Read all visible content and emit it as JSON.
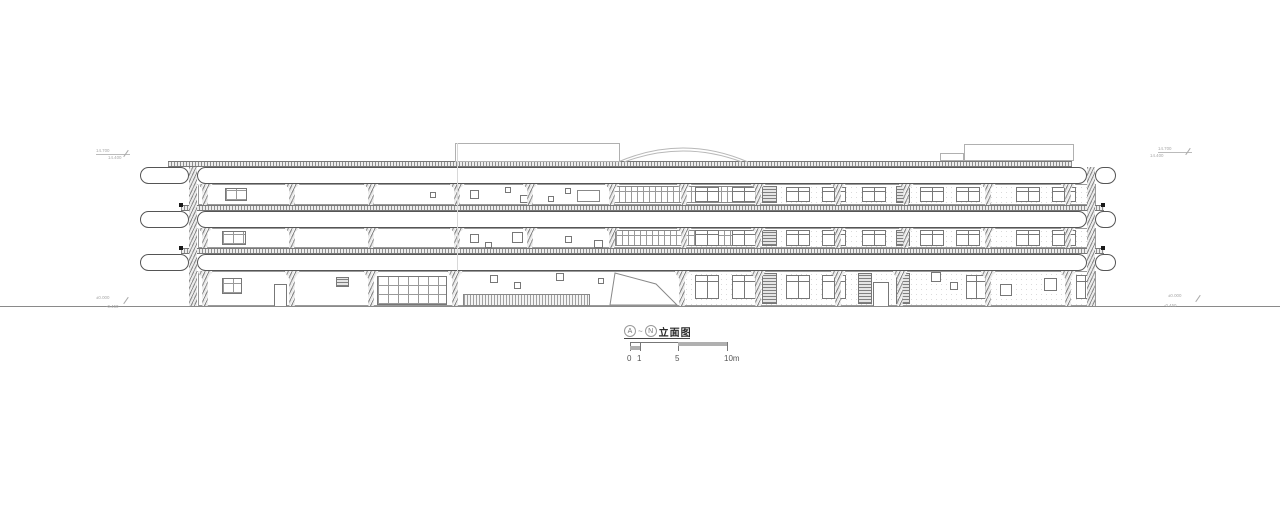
{
  "title_block": {
    "mark_a": "A",
    "tilde": "~",
    "mark_n": "N",
    "title": "立面图"
  },
  "scale_bar": {
    "y": 342,
    "x0": 630,
    "x1": 727,
    "ticks": [
      {
        "x": 630,
        "label": "0"
      },
      {
        "x": 640,
        "label": "1"
      },
      {
        "x": 678,
        "label": "5"
      },
      {
        "x": 727,
        "label": "10m"
      }
    ],
    "fills": [
      {
        "x": 678,
        "dy": 0,
        "w": 49,
        "h": 4
      },
      {
        "x": 630,
        "dy": 4,
        "w": 10,
        "h": 4
      }
    ]
  },
  "drawing": {
    "colors": {
      "ink": "#555555",
      "light": "#aaaaaa",
      "hatch": "#8a8a8a",
      "paper": "#ffffff"
    },
    "ground_y": 306,
    "joint_line": {
      "x": 457,
      "y": 143,
      "h": 129
    },
    "levels": [
      {
        "strip": {
          "x": 168,
          "y": 161,
          "w": 904,
          "h": 6
        },
        "capsules": [
          {
            "x": 140,
            "y": 167,
            "w": 49,
            "h": 17
          },
          {
            "x": 197,
            "y": 167,
            "w": 890,
            "h": 17
          },
          {
            "x": 1095,
            "y": 167,
            "w": 21,
            "h": 17
          }
        ]
      },
      {
        "strip": {
          "x": 181,
          "y": 205,
          "w": 923,
          "h": 6
        },
        "capsules": [
          {
            "x": 140,
            "y": 211,
            "w": 49,
            "h": 17
          },
          {
            "x": 197,
            "y": 211,
            "w": 890,
            "h": 17
          },
          {
            "x": 1095,
            "y": 211,
            "w": 21,
            "h": 17
          }
        ]
      },
      {
        "strip": {
          "x": 181,
          "y": 248,
          "w": 923,
          "h": 6
        },
        "capsules": [
          {
            "x": 140,
            "y": 254,
            "w": 49,
            "h": 17
          },
          {
            "x": 197,
            "y": 254,
            "w": 890,
            "h": 17
          },
          {
            "x": 1095,
            "y": 254,
            "w": 21,
            "h": 17
          }
        ]
      }
    ],
    "edge_columns": [
      {
        "x": 189,
        "y": 167,
        "w": 8,
        "h": 139
      },
      {
        "x": 1087,
        "y": 167,
        "w": 8,
        "h": 139
      }
    ],
    "dots": [
      [
        179,
        203
      ],
      [
        179,
        246
      ],
      [
        1101,
        203
      ],
      [
        1101,
        246
      ]
    ],
    "col_w": 16,
    "floors": [
      {
        "name": "third-floor",
        "y": 184,
        "h": 21,
        "wall_x": 198,
        "wall_w": 898,
        "columns": [
          205,
          292,
          371,
          457,
          530,
          612,
          684,
          758,
          838,
          906,
          988,
          1068
        ],
        "elements": [
          {
            "t": "stipple",
            "x": 684,
            "dy": 1,
            "w": 410,
            "h": 19
          },
          {
            "t": "gridwin",
            "x": 225,
            "dy": 4,
            "w": 22,
            "h": 13
          },
          {
            "t": "sq",
            "x": 430,
            "dy": 8,
            "w": 6,
            "h": 6
          },
          {
            "t": "sq",
            "x": 470,
            "dy": 6,
            "w": 9,
            "h": 9
          },
          {
            "t": "sq",
            "x": 505,
            "dy": 3,
            "w": 6,
            "h": 6
          },
          {
            "t": "sq",
            "x": 520,
            "dy": 11,
            "w": 9,
            "h": 8
          },
          {
            "t": "sq",
            "x": 548,
            "dy": 12,
            "w": 6,
            "h": 6
          },
          {
            "t": "sq",
            "x": 565,
            "dy": 4,
            "w": 6,
            "h": 6
          },
          {
            "t": "rect",
            "x": 577,
            "dy": 6,
            "w": 23,
            "h": 12
          },
          {
            "t": "mull",
            "x": 612,
            "dy": 2,
            "w": 145,
            "h": 17
          },
          {
            "t": "louver",
            "x": 762,
            "dy": 2,
            "w": 15,
            "h": 17
          },
          {
            "t": "louver",
            "x": 896,
            "dy": 2,
            "w": 14,
            "h": 17
          },
          {
            "t": "win2",
            "x": 695,
            "dy": 3,
            "w": 24,
            "h": 15
          },
          {
            "t": "win2",
            "x": 732,
            "dy": 3,
            "w": 24,
            "h": 15
          },
          {
            "t": "win2",
            "x": 786,
            "dy": 3,
            "w": 24,
            "h": 15
          },
          {
            "t": "win2",
            "x": 822,
            "dy": 3,
            "w": 24,
            "h": 15
          },
          {
            "t": "win2",
            "x": 862,
            "dy": 3,
            "w": 24,
            "h": 15
          },
          {
            "t": "win2",
            "x": 920,
            "dy": 3,
            "w": 24,
            "h": 15
          },
          {
            "t": "win2",
            "x": 956,
            "dy": 3,
            "w": 24,
            "h": 15
          },
          {
            "t": "win2",
            "x": 1016,
            "dy": 3,
            "w": 24,
            "h": 15
          },
          {
            "t": "win2",
            "x": 1052,
            "dy": 3,
            "w": 24,
            "h": 15
          }
        ]
      },
      {
        "name": "second-floor",
        "y": 228,
        "h": 20,
        "wall_x": 198,
        "wall_w": 898,
        "columns": [
          205,
          292,
          371,
          457,
          530,
          612,
          684,
          758,
          838,
          906,
          988,
          1068
        ],
        "elements": [
          {
            "t": "stipple",
            "x": 684,
            "dy": 1,
            "w": 410,
            "h": 18
          },
          {
            "t": "gridwin",
            "x": 222,
            "dy": 3,
            "w": 24,
            "h": 14
          },
          {
            "t": "sq",
            "x": 470,
            "dy": 6,
            "w": 9,
            "h": 9
          },
          {
            "t": "sq",
            "x": 485,
            "dy": 14,
            "w": 7,
            "h": 6
          },
          {
            "t": "sq",
            "x": 512,
            "dy": 4,
            "w": 11,
            "h": 11
          },
          {
            "t": "sq",
            "x": 565,
            "dy": 8,
            "w": 7,
            "h": 7
          },
          {
            "t": "sq",
            "x": 594,
            "dy": 12,
            "w": 9,
            "h": 8
          },
          {
            "t": "mull",
            "x": 615,
            "dy": 2,
            "w": 142,
            "h": 16
          },
          {
            "t": "louver",
            "x": 762,
            "dy": 2,
            "w": 15,
            "h": 16
          },
          {
            "t": "louver",
            "x": 896,
            "dy": 2,
            "w": 14,
            "h": 16
          },
          {
            "t": "win2",
            "x": 695,
            "dy": 2,
            "w": 24,
            "h": 16
          },
          {
            "t": "win2",
            "x": 732,
            "dy": 2,
            "w": 24,
            "h": 16
          },
          {
            "t": "win2",
            "x": 786,
            "dy": 2,
            "w": 24,
            "h": 16
          },
          {
            "t": "win2",
            "x": 822,
            "dy": 2,
            "w": 24,
            "h": 16
          },
          {
            "t": "win2",
            "x": 862,
            "dy": 2,
            "w": 24,
            "h": 16
          },
          {
            "t": "win2",
            "x": 920,
            "dy": 2,
            "w": 24,
            "h": 16
          },
          {
            "t": "win2",
            "x": 956,
            "dy": 2,
            "w": 24,
            "h": 16
          },
          {
            "t": "win2",
            "x": 1016,
            "dy": 2,
            "w": 24,
            "h": 16
          },
          {
            "t": "win2",
            "x": 1052,
            "dy": 2,
            "w": 24,
            "h": 16
          }
        ]
      },
      {
        "name": "ground-floor",
        "y": 271,
        "h": 35,
        "wall_x": 198,
        "wall_w": 898,
        "columns": [
          205,
          292,
          371,
          455,
          682,
          758,
          838,
          900,
          988,
          1068
        ],
        "elements": [
          {
            "t": "stipple",
            "x": 684,
            "dy": 1,
            "w": 410,
            "h": 33
          },
          {
            "t": "gridwin",
            "x": 222,
            "dy": 7,
            "w": 20,
            "h": 16
          },
          {
            "t": "door",
            "x": 274,
            "dy": 13,
            "w": 13,
            "h": 22
          },
          {
            "t": "louver",
            "x": 336,
            "dy": 6,
            "w": 13,
            "h": 10
          },
          {
            "t": "gridwin",
            "x": 377,
            "dy": 5,
            "w": 70,
            "h": 29
          },
          {
            "t": "fence",
            "x": 463,
            "dy": 23,
            "w": 127,
            "h": 12
          },
          {
            "t": "sq",
            "x": 490,
            "dy": 4,
            "w": 8,
            "h": 8
          },
          {
            "t": "sq",
            "x": 514,
            "dy": 11,
            "w": 7,
            "h": 7
          },
          {
            "t": "sq",
            "x": 556,
            "dy": 2,
            "w": 8,
            "h": 8
          },
          {
            "t": "sq",
            "x": 598,
            "dy": 7,
            "w": 6,
            "h": 6
          },
          {
            "t": "slide",
            "x": 610,
            "dy": 1,
            "w": 68,
            "h": 34
          },
          {
            "t": "win2",
            "x": 695,
            "dy": 4,
            "w": 24,
            "h": 24
          },
          {
            "t": "win2",
            "x": 732,
            "dy": 4,
            "w": 24,
            "h": 24
          },
          {
            "t": "win2",
            "x": 786,
            "dy": 4,
            "w": 24,
            "h": 24
          },
          {
            "t": "win2",
            "x": 822,
            "dy": 4,
            "w": 24,
            "h": 24
          },
          {
            "t": "louver",
            "x": 762,
            "dy": 2,
            "w": 15,
            "h": 31
          },
          {
            "t": "louver",
            "x": 858,
            "dy": 2,
            "w": 14,
            "h": 31
          },
          {
            "t": "louver",
            "x": 896,
            "dy": 2,
            "w": 14,
            "h": 31
          },
          {
            "t": "door",
            "x": 873,
            "dy": 11,
            "w": 16,
            "h": 24
          },
          {
            "t": "sq",
            "x": 931,
            "dy": 1,
            "w": 10,
            "h": 10
          },
          {
            "t": "sq",
            "x": 950,
            "dy": 11,
            "w": 8,
            "h": 8
          },
          {
            "t": "win2",
            "x": 966,
            "dy": 4,
            "w": 20,
            "h": 24
          },
          {
            "t": "sq",
            "x": 1000,
            "dy": 13,
            "w": 12,
            "h": 12
          },
          {
            "t": "sq",
            "x": 1044,
            "dy": 7,
            "w": 13,
            "h": 13
          },
          {
            "t": "win2",
            "x": 1076,
            "dy": 4,
            "w": 18,
            "h": 24
          }
        ]
      }
    ],
    "roof": {
      "box_left": {
        "x": 455,
        "y": 143,
        "w": 165,
        "h": 19
      },
      "box_right": {
        "x": 964,
        "y": 144,
        "w": 110,
        "h": 17
      },
      "box_right_step": {
        "x": 940,
        "y": 153,
        "w": 24,
        "h": 8
      },
      "arch": {
        "x": 616,
        "y": 134,
        "w": 134,
        "h": 28
      }
    },
    "markers": [
      {
        "x": 96,
        "y": 148,
        "l1": "14.700",
        "l2": "14.400",
        "l2dx": 12,
        "l2dy": 7,
        "topline": true
      },
      {
        "x": 1158,
        "y": 146,
        "l1": "14.700",
        "l2": "14.400",
        "l2dx": -8,
        "l2dy": 7,
        "topline": true
      },
      {
        "x": 96,
        "y": 295,
        "l1": "±0.000",
        "l2": "-0.450",
        "l2dx": 10,
        "l2dy": 9,
        "topline": false
      },
      {
        "x": 1168,
        "y": 293,
        "l1": "±0.000",
        "l2": "-0.450",
        "l2dx": -4,
        "l2dy": 10,
        "topline": false
      }
    ]
  }
}
